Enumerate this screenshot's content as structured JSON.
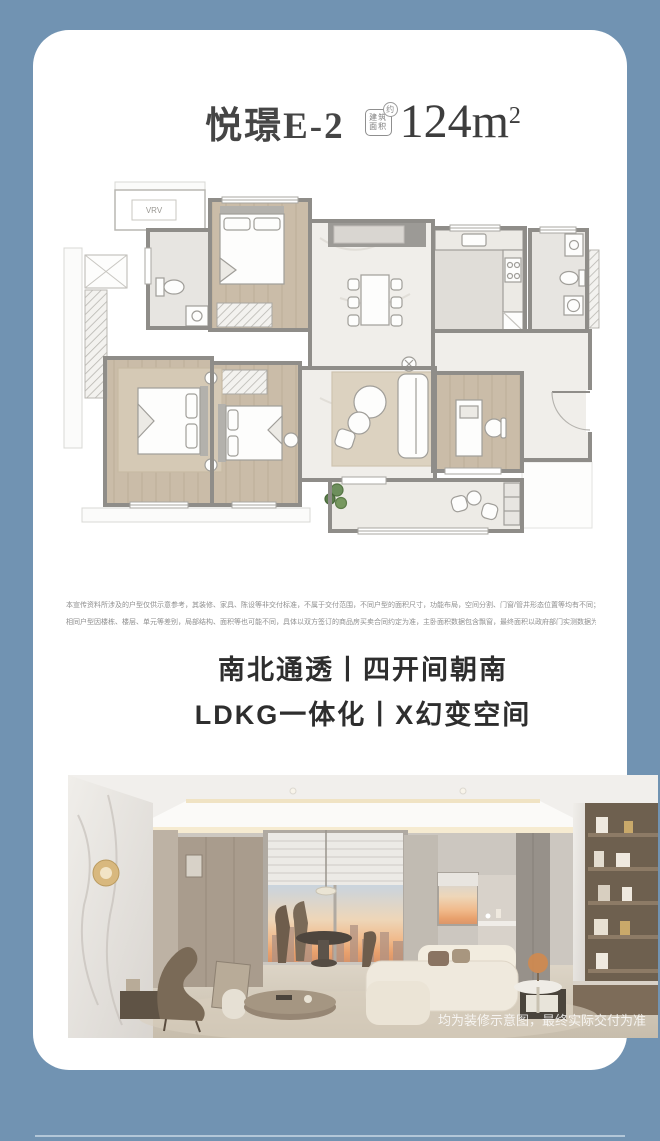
{
  "page": {
    "background_color": "#7193b2",
    "card_color": "#ffffff"
  },
  "header": {
    "plan_name": "悦璟E-2",
    "area_badge_line1": "建筑",
    "area_badge_line2": "面积",
    "area_badge_approx": "约",
    "area_value": "124m",
    "area_exponent": "2"
  },
  "floorplan": {
    "vrv_label": "VRV",
    "colors": {
      "wall": "#8f8d89",
      "wood_floor": "#cabca8",
      "marble_floor": "#f0eeea",
      "tile_floor": "#e7e5e1",
      "balcony_floor": "#edebe6"
    }
  },
  "disclaimer": {
    "line1": "本宣传资料所涉及的户型仅供示意参考，其装修、家具、陈设等非交付标准，不属于交付范围，不同户型的面积尺寸，功能布局，空间分割、门窗/管井形态位置等均有不同；",
    "line2": "相同户型因楼栋、楼层、单元等差别，局部结构、面积等也可能不同，具体以双方签订的商品房买卖合同约定为准，主卧面积数据包含飘窗，最终面积以政府部门实测数据为准"
  },
  "taglines": {
    "line1": "南北通透丨四开间朝南",
    "line2": "LDKG一体化丨X幻变空间"
  },
  "photo": {
    "watermark": "均为装修示意图，最终实际交付为准"
  }
}
